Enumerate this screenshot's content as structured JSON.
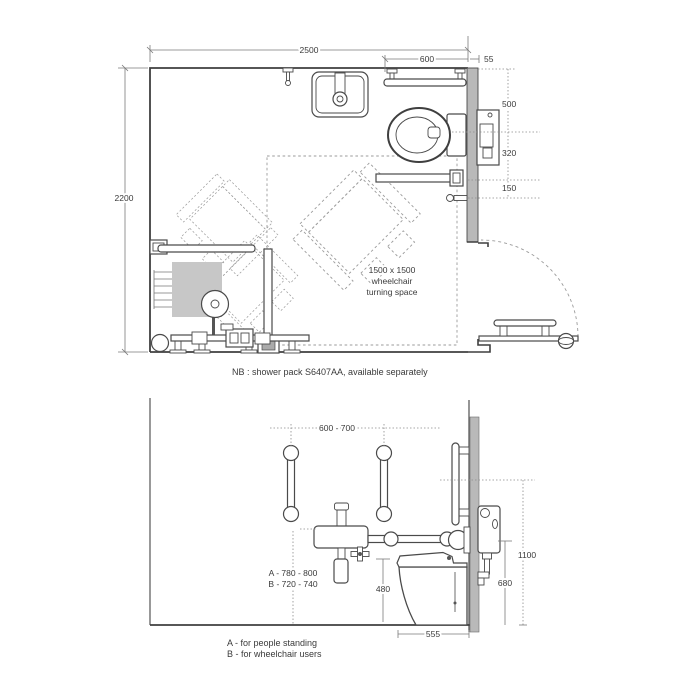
{
  "plan": {
    "dim_2500": "2500",
    "dim_600": "600",
    "dim_55": "55",
    "dim_2200": "2200",
    "dim_500": "500",
    "dim_320": "320",
    "dim_150": "150",
    "turning_line1": "1500 x 1500",
    "turning_line2": "wheelchair",
    "turning_line3": "turning space",
    "note": "NB : shower pack S6407AA, available separately"
  },
  "elevation": {
    "dim_rail_spacing": "600 - 700",
    "dim_height_a": "A - 780 - 800",
    "dim_height_b": "B - 720 - 740",
    "dim_seat_height": "480",
    "dim_projection": "555",
    "dim_arm_height": "680",
    "dim_cistern_height": "1100",
    "legend_a": "A - for people standing",
    "legend_b": "B - for wheelchair users"
  },
  "colors": {
    "line": "#4a4a4a",
    "wall_fill": "#b9b9b9",
    "seat_fill": "#c7c7c7",
    "dim": "#7a7a7a",
    "background": "#ffffff"
  }
}
